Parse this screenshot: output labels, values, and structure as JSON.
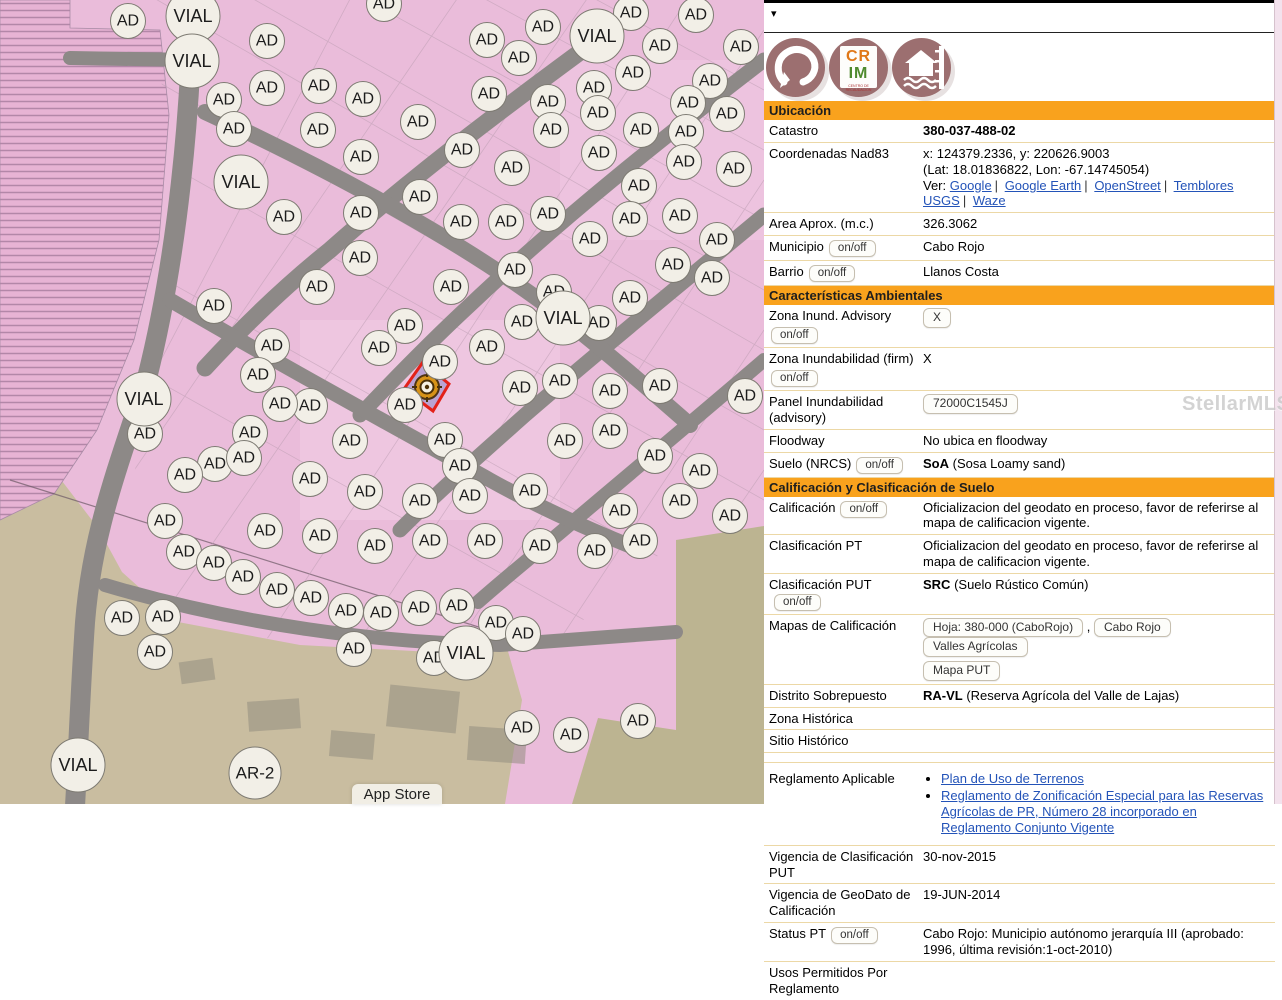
{
  "watermark": "StellarMLS",
  "topbar": {
    "collapse_arrow": "▾"
  },
  "logos": {
    "crim": {
      "line1": "CR",
      "line2": "IM",
      "caption": "CENTRO DE RECAUDACION"
    }
  },
  "map": {
    "badge_ad_label": "AD",
    "badge_vial_label": "VIAL",
    "badge_ar2_label": "AR-2",
    "app_store_label": "App Store",
    "colors": {
      "parcel_pink": "#eabcda",
      "hatch_line": "#b387a8",
      "road_gray": "#8d8987",
      "ground_tan": "#c9bda0",
      "ground_olive": "#bcb491",
      "selected_outline": "#e32119",
      "selected_fill": "#8f86c9",
      "marker_orange": "#d9930f"
    },
    "ad_positions": [
      [
        384,
        4
      ],
      [
        631,
        13
      ],
      [
        696,
        15
      ],
      [
        128,
        21
      ],
      [
        543,
        27
      ],
      [
        267,
        41
      ],
      [
        660,
        46
      ],
      [
        741,
        47
      ],
      [
        487,
        40
      ],
      [
        519,
        58
      ],
      [
        633,
        73
      ],
      [
        710,
        81
      ],
      [
        319,
        86
      ],
      [
        267,
        88
      ],
      [
        594,
        88
      ],
      [
        489,
        94
      ],
      [
        363,
        99
      ],
      [
        224,
        100
      ],
      [
        548,
        102
      ],
      [
        688,
        103
      ],
      [
        598,
        113
      ],
      [
        727,
        114
      ],
      [
        418,
        122
      ],
      [
        234,
        129
      ],
      [
        318,
        130
      ],
      [
        551,
        130
      ],
      [
        641,
        130
      ],
      [
        686,
        132
      ],
      [
        462,
        150
      ],
      [
        599,
        153
      ],
      [
        361,
        157
      ],
      [
        684,
        162
      ],
      [
        512,
        168
      ],
      [
        734,
        169
      ],
      [
        639,
        186
      ],
      [
        420,
        197
      ],
      [
        361,
        213
      ],
      [
        548,
        214
      ],
      [
        630,
        219
      ],
      [
        680,
        216
      ],
      [
        284,
        217
      ],
      [
        461,
        222
      ],
      [
        506,
        222
      ],
      [
        590,
        239
      ],
      [
        717,
        240
      ],
      [
        360,
        258
      ],
      [
        673,
        265
      ],
      [
        515,
        270
      ],
      [
        712,
        278
      ],
      [
        317,
        287
      ],
      [
        451,
        287
      ],
      [
        554,
        292
      ],
      [
        630,
        298
      ],
      [
        599,
        323
      ],
      [
        214,
        306
      ],
      [
        405,
        326
      ],
      [
        272,
        346
      ],
      [
        379,
        348
      ],
      [
        487,
        347
      ],
      [
        522,
        322
      ],
      [
        440,
        362
      ],
      [
        258,
        375
      ],
      [
        520,
        388
      ],
      [
        560,
        381
      ],
      [
        610,
        391
      ],
      [
        660,
        386
      ],
      [
        745,
        396
      ],
      [
        405,
        405
      ],
      [
        310,
        406
      ],
      [
        445,
        440
      ],
      [
        145,
        434
      ],
      [
        250,
        433
      ],
      [
        280,
        404
      ],
      [
        215,
        464
      ],
      [
        350,
        441
      ],
      [
        460,
        466
      ],
      [
        565,
        441
      ],
      [
        610,
        431
      ],
      [
        655,
        456
      ],
      [
        700,
        471
      ],
      [
        185,
        475
      ],
      [
        244,
        458
      ],
      [
        310,
        479
      ],
      [
        365,
        492
      ],
      [
        420,
        501
      ],
      [
        470,
        496
      ],
      [
        530,
        491
      ],
      [
        620,
        511
      ],
      [
        680,
        501
      ],
      [
        730,
        516
      ],
      [
        165,
        521
      ],
      [
        265,
        531
      ],
      [
        320,
        536
      ],
      [
        375,
        546
      ],
      [
        430,
        541
      ],
      [
        485,
        541
      ],
      [
        540,
        546
      ],
      [
        595,
        551
      ],
      [
        640,
        541
      ],
      [
        184,
        552
      ],
      [
        214,
        563
      ],
      [
        243,
        577
      ],
      [
        277,
        590
      ],
      [
        311,
        598
      ],
      [
        346,
        611
      ],
      [
        381,
        613
      ],
      [
        419,
        608
      ],
      [
        457,
        606
      ],
      [
        496,
        623
      ],
      [
        523,
        634
      ],
      [
        122,
        618
      ],
      [
        163,
        617
      ],
      [
        155,
        652
      ],
      [
        354,
        649
      ],
      [
        434,
        658
      ],
      [
        522,
        728
      ],
      [
        571,
        735
      ],
      [
        638,
        721
      ]
    ],
    "vial_positions": [
      [
        193,
        16
      ],
      [
        192,
        61
      ],
      [
        597,
        36
      ],
      [
        241,
        182
      ],
      [
        563,
        318
      ],
      [
        144,
        399
      ],
      [
        466,
        653
      ],
      [
        78,
        765
      ]
    ],
    "ar2_position": [
      255,
      773
    ]
  },
  "panel": {
    "ubicacion": {
      "title": "Ubicación"
    },
    "catastro": {
      "label": "Catastro",
      "value": "380-037-488-02"
    },
    "coordenadas": {
      "label": "Coordenadas Nad83",
      "line1": "x: 124379.2336, y: 220626.9003",
      "line2": "(Lat: 18.01836822, Lon: -67.14745054)",
      "ver_prefix": "Ver:",
      "links": [
        "Google",
        "Google Earth",
        "OpenStreet",
        "Temblores USGS",
        "Waze"
      ],
      "sep": "|"
    },
    "area": {
      "label": "Area Aprox. (m.c.)",
      "value": "326.3062"
    },
    "municipio": {
      "label": "Municipio",
      "toggle": "on/off",
      "value": "Cabo Rojo"
    },
    "barrio": {
      "label": "Barrio",
      "toggle": "on/off",
      "value": "Llanos Costa"
    },
    "ambientales": {
      "title": "Características Ambientales"
    },
    "zona_inund_advisory": {
      "label": "Zona Inund. Advisory",
      "toggle": "on/off",
      "value_button": "X"
    },
    "zona_inund_firm": {
      "label": "Zona Inundabilidad (firm)",
      "toggle": "on/off",
      "value": "X"
    },
    "panel_inund": {
      "label": "Panel Inundabilidad (advisory)",
      "value_button": "72000C1545J"
    },
    "floodway": {
      "label": "Floodway",
      "value": "No ubica en floodway"
    },
    "suelo": {
      "label": "Suelo (NRCS)",
      "toggle": "on/off",
      "value_bold": "SoA",
      "value_rest": " (Sosa Loamy sand)"
    },
    "calificacion_header": {
      "title": "Calificación y Clasificación de Suelo"
    },
    "calificacion": {
      "label": "Calificación",
      "toggle": "on/off",
      "value": "Oficializacion del geodato en proceso, favor de referirse al mapa de calificacion vigente."
    },
    "clasificacion_pt": {
      "label": "Clasificación PT",
      "value": "Oficializacion del geodato en proceso, favor de referirse al mapa de calificacion vigente."
    },
    "clasificacion_put": {
      "label": "Clasificación PUT",
      "toggle": "on/off",
      "value_bold": "SRC",
      "value_rest": " (Suelo Rústico Común)"
    },
    "mapas": {
      "label": "Mapas de Calificación",
      "comma": ",",
      "buttons": [
        "Hoja: 380-000 (CaboRojo)",
        "Cabo Rojo",
        "Valles Agrícolas",
        "Mapa PUT"
      ]
    },
    "distrito": {
      "label": "Distrito Sobrepuesto",
      "value_bold": "RA-VL",
      "value_rest": " (Reserva Agrícola del Valle de Lajas)"
    },
    "zona_historica": {
      "label": "Zona Histórica"
    },
    "sitio_historico": {
      "label": "Sitio Histórico"
    },
    "reglamento": {
      "label": "Reglamento Aplicable",
      "links": [
        "Plan de Uso de Terrenos",
        "Reglamento de Zonificación Especial para las Reservas Agrícolas de PR, Número 28 incorporado en Reglamento Conjunto Vigente"
      ]
    },
    "vigencia_put": {
      "label": "Vigencia de Clasificación PUT",
      "value": "30-nov-2015"
    },
    "vigencia_geodato": {
      "label": "Vigencia de GeoDato de Calificación",
      "value": "19-JUN-2014"
    },
    "status_pt": {
      "label": "Status PT",
      "toggle": "on/off",
      "value": "Cabo Rojo: Municipio autónomo jerarquía III (aprobado: 1996, última revisión:1-oct-2010)"
    },
    "usos": {
      "label": "Usos Permitidos Por Reglamento"
    }
  }
}
